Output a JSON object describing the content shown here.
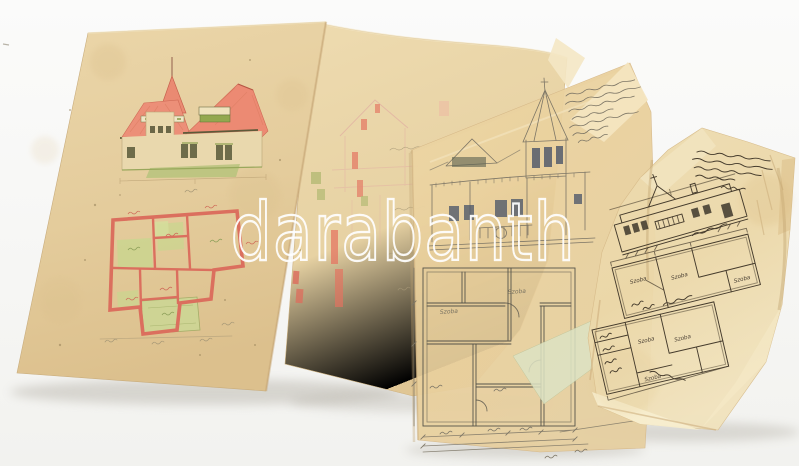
{
  "watermark": {
    "text": "darabanth",
    "color": "#ffffff"
  },
  "plan_room_labels": {
    "pencil_1": "Szoba",
    "pencil_2": "Szoba",
    "ink_1": "Szoba",
    "ink_2": "Szoba",
    "ink_3": "Szoba",
    "ink_4": "Szoba",
    "ink_5": "Szoba",
    "ink_6": "Szoba"
  },
  "colors": {
    "background": "#f8f8f6",
    "aged_paper": "#e6d0a2",
    "aged_paper_light": "#efe0ba",
    "tracing_paper": "#ecd9ae",
    "tracing_green_edge": "#dde3c4",
    "roof_red": "#ec8a73",
    "plan_wall_red": "#db6f5e",
    "lawn_green": "#b7c37d",
    "room_green": "#c9d68f",
    "window_slate": "#4e586a",
    "pencil_gray": "#7d7666",
    "ink_brown": "#453b2c",
    "watermark_white": "#ffffff"
  }
}
